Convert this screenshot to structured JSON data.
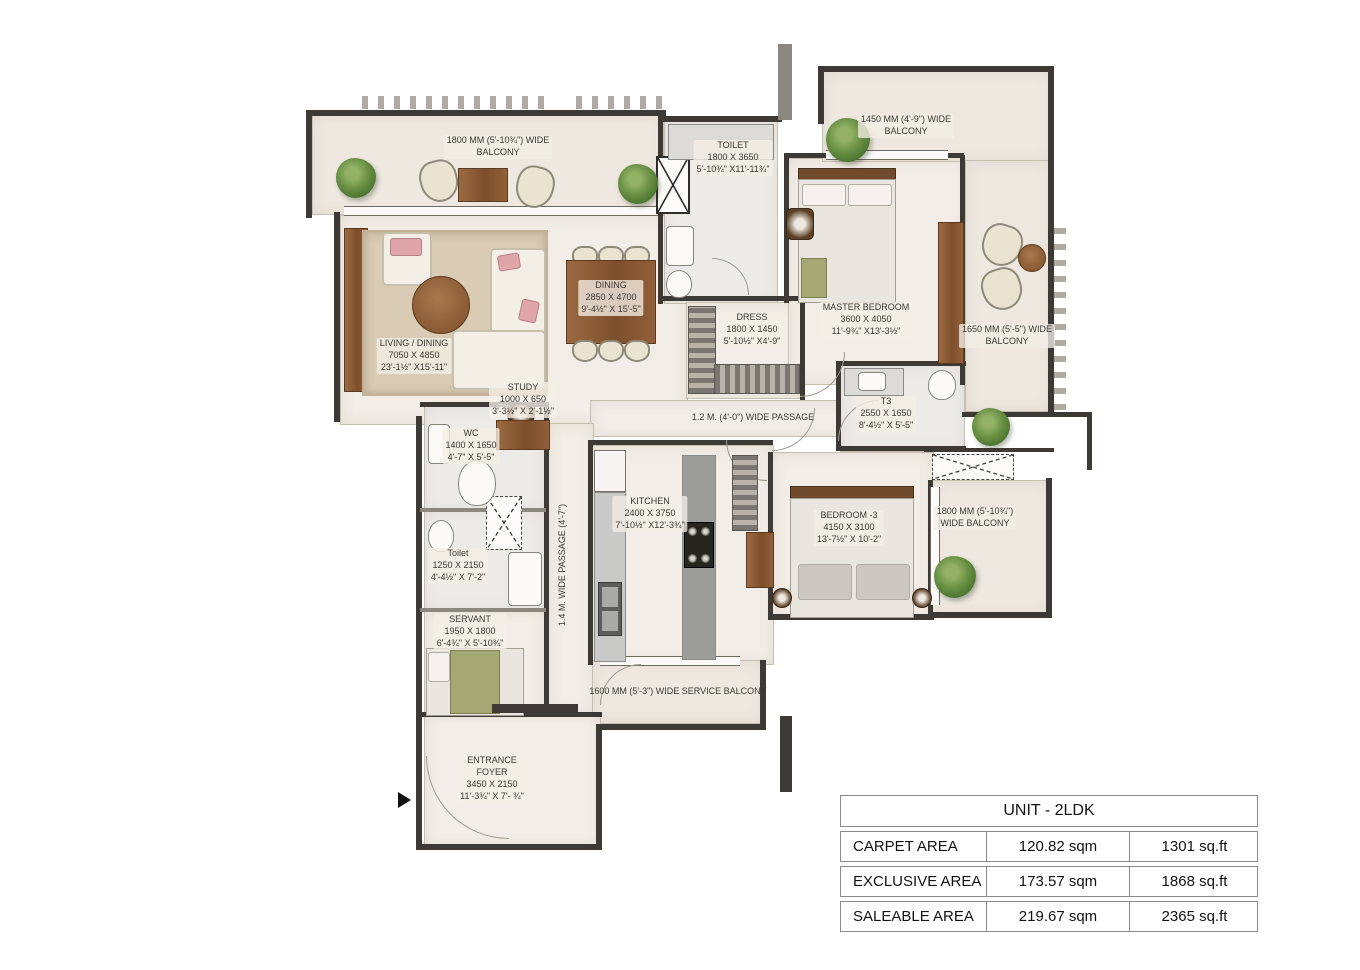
{
  "rooms": {
    "balcony_top": {
      "l1": "1800 MM (5'-10¾\") WIDE",
      "l2": "BALCONY"
    },
    "balcony_tr": {
      "l1": "1450 MM (4'-9\") WIDE",
      "l2": "BALCONY"
    },
    "balcony_right": {
      "l1": "1650 MM (5'-5\") WIDE",
      "l2": "BALCONY"
    },
    "balcony_1800": {
      "l1": "1800 MM (5'-10¾\")",
      "l2": "WIDE BALCONY"
    },
    "service_balcony": {
      "l1": "1600 MM (5'-3\") WIDE SERVICE BALCONY"
    },
    "toilet_top": {
      "name": "TOILET",
      "mm": "1800 X 3650",
      "ft": "5'-10¾\" X11'-11¾\""
    },
    "master": {
      "name": "MASTER BEDROOM",
      "mm": "3600 X 4050",
      "ft": "11'-9¾\" X13'-3½\""
    },
    "living": {
      "name": "LIVING / DINING",
      "mm": "7050 X 4850",
      "ft": "23'-1½\" X15'-11\""
    },
    "dining": {
      "name": "DINING",
      "mm": "2850 X 4700",
      "ft": "9'-4½\" X 15'-5\""
    },
    "dress": {
      "name": "DRESS",
      "mm": "1800 X 1450",
      "ft": "5'-10½\" X4'-9\""
    },
    "t3": {
      "name": "T3",
      "mm": "2550 X 1650",
      "ft": "8'-4½\" X 5'-5\""
    },
    "study": {
      "name": "STUDY",
      "mm": "1000 X 650",
      "ft": "3'-3½\" X 2'-1½\""
    },
    "wc": {
      "name": "WC",
      "mm": "1400 X 1650",
      "ft": "4'-7\" X 5'-5\""
    },
    "kitchen": {
      "name": "KITCHEN",
      "mm": "2400 X 3750",
      "ft": "7'-10½\" X12'-3¾\""
    },
    "bedroom3": {
      "name": "BEDROOM -3",
      "mm": "4150 X 3100",
      "ft": "13'-7½\" X 10'-2\""
    },
    "toilet_left": {
      "name": "Toilet",
      "mm": "1250 X 2150",
      "ft": "4'-4½\" X 7'-2\""
    },
    "servant": {
      "name": "SERVANT",
      "mm": "1950 X 1800",
      "ft": "6'-4¾\" X 5'-10¾\""
    },
    "foyer": {
      "name1": "ENTRANCE",
      "name2": "FOYER",
      "mm": "3450 X 2150",
      "ft": "11'-3¾\" X 7'- ¾\""
    },
    "passage12": {
      "l1": "1.2 M. (4'-0\")  WIDE PASSAGE"
    },
    "passage14": {
      "l1": "1.4 M. WIDE PASSAGE (4'-7\")"
    }
  },
  "unit_table": {
    "title": "UNIT - 2LDK",
    "rows": [
      {
        "label": "CARPET AREA",
        "sqm": "120.82 sqm",
        "sqft": "1301 sq.ft"
      },
      {
        "label": "EXCLUSIVE AREA",
        "sqm": "173.57 sqm",
        "sqft": "1868 sq.ft"
      },
      {
        "label": "SALEABLE AREA",
        "sqm": "219.67 sqm",
        "sqft": "2365 sq.ft"
      }
    ]
  },
  "icons": {
    "entrance_arrow": "right-filled-triangle",
    "plant": "green-shrub",
    "shaft": "x-cross-box"
  },
  "colors": {
    "wall": "#3d3a36",
    "floor": "#f2ede6",
    "balcony_floor": "#eee8e0",
    "wood": "#8a5a38",
    "rug": "#d9cbb4",
    "accent_pink": "#e0a5aa",
    "plant_green": "#5d8440"
  }
}
